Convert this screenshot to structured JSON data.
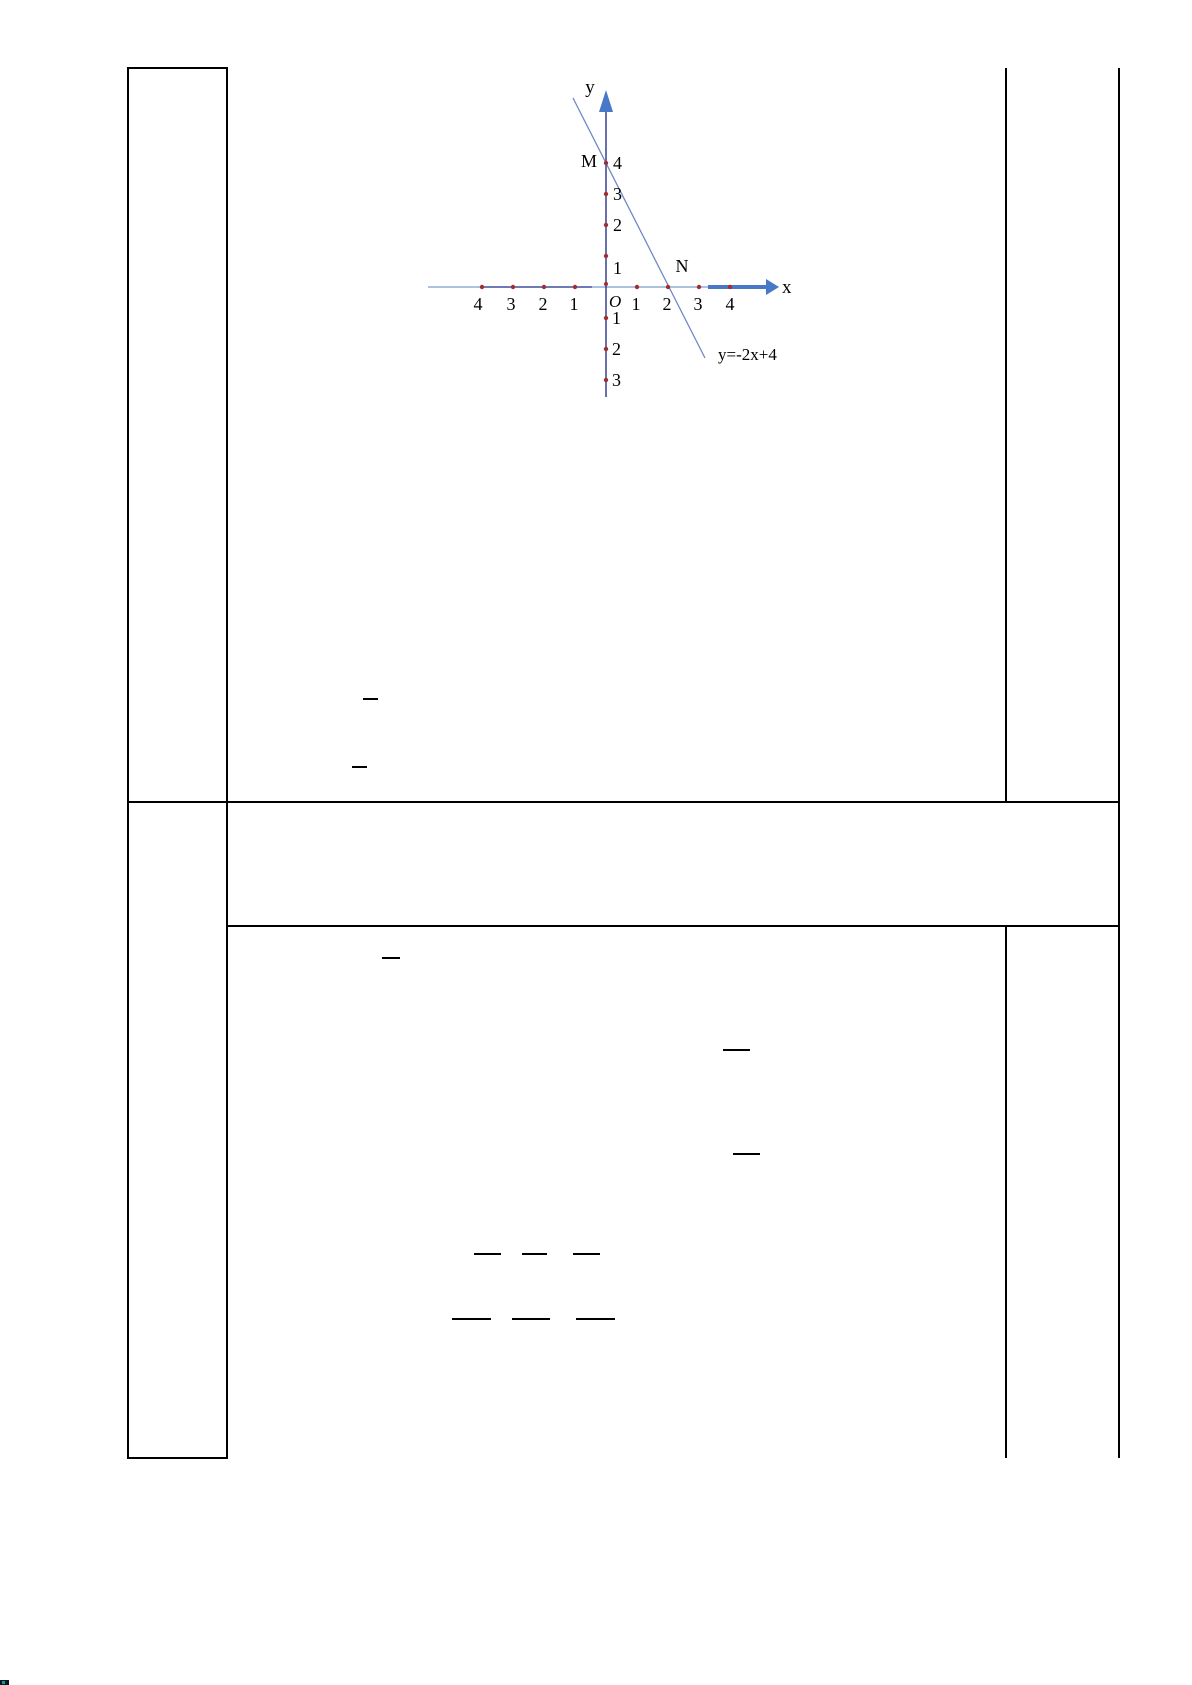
{
  "page": {
    "background": "#ffffff",
    "border_color": "#000000",
    "content_text": ""
  },
  "chart_data": {
    "type": "line",
    "title": "",
    "x_axis_label": "x",
    "y_axis_label": "y",
    "origin_label": "O",
    "x_tick_labels": [
      "4",
      "3",
      "2",
      "1",
      "1",
      "2",
      "3",
      "4"
    ],
    "y_tick_labels_positive": [
      "4",
      "3",
      "2",
      "1"
    ],
    "y_tick_labels_negative": [
      "1",
      "2",
      "3"
    ],
    "xlim": [
      -4.5,
      5.5
    ],
    "ylim": [
      -3.6,
      6.3
    ],
    "grid": false,
    "legend": "none",
    "series": [
      {
        "name": "y=-2x+4",
        "equation_label": "y=-2x+4",
        "slope": -2,
        "y_intercept": 4,
        "x_intercept": 2,
        "points": [
          [
            0,
            4
          ],
          [
            2,
            0
          ]
        ]
      }
    ],
    "marked_points": [
      {
        "label": "M",
        "x": 0,
        "y": 4
      },
      {
        "label": "N",
        "x": 2,
        "y": 0
      }
    ],
    "axis_dot_positions_x": [
      -4,
      -3,
      -2,
      -1,
      1,
      2,
      3,
      4
    ],
    "axis_dot_positions_y": [
      -3,
      -2,
      -1,
      1,
      2,
      3,
      4
    ],
    "colors": {
      "axis": "#27348b",
      "axis_light": "#7e9cc9",
      "arrow": "#4878c8",
      "line": "#7188c7",
      "dots": "#a03030",
      "text": "#000000"
    }
  }
}
